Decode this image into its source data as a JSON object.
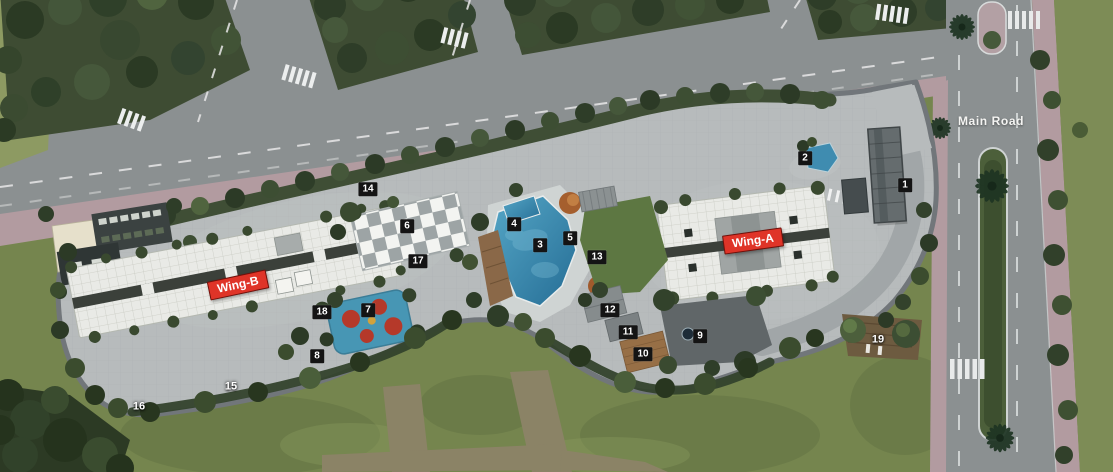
{
  "canvas": {
    "width": 1113,
    "height": 472
  },
  "scene": "aerial master plan render of residential complex",
  "road_label": {
    "text": "Main Road",
    "x": 991,
    "y": 121
  },
  "wing_labels": [
    {
      "id": "wing-b",
      "text": "Wing-B",
      "x": 238,
      "y": 285,
      "rotation": -12,
      "bg": "#df3428",
      "fg": "#ffffff"
    },
    {
      "id": "wing-a",
      "text": "Wing-A",
      "x": 753,
      "y": 241,
      "rotation": -8,
      "bg": "#df3428",
      "fg": "#ffffff"
    }
  ],
  "markers": [
    {
      "num": "1",
      "x": 905,
      "y": 185,
      "boxed": true
    },
    {
      "num": "2",
      "x": 805,
      "y": 158,
      "boxed": true
    },
    {
      "num": "3",
      "x": 540,
      "y": 245,
      "boxed": true
    },
    {
      "num": "4",
      "x": 514,
      "y": 224,
      "boxed": true
    },
    {
      "num": "5",
      "x": 570,
      "y": 238,
      "boxed": true
    },
    {
      "num": "6",
      "x": 407,
      "y": 226,
      "boxed": true
    },
    {
      "num": "7",
      "x": 368,
      "y": 310,
      "boxed": true
    },
    {
      "num": "8",
      "x": 317,
      "y": 356,
      "boxed": true
    },
    {
      "num": "9",
      "x": 700,
      "y": 336,
      "boxed": true
    },
    {
      "num": "10",
      "x": 643,
      "y": 354,
      "boxed": true
    },
    {
      "num": "11",
      "x": 628,
      "y": 332,
      "boxed": true
    },
    {
      "num": "12",
      "x": 610,
      "y": 310,
      "boxed": true
    },
    {
      "num": "13",
      "x": 597,
      "y": 257,
      "boxed": true
    },
    {
      "num": "14",
      "x": 368,
      "y": 189,
      "boxed": true
    },
    {
      "num": "15",
      "x": 231,
      "y": 387,
      "boxed": false
    },
    {
      "num": "16",
      "x": 139,
      "y": 407,
      "boxed": false
    },
    {
      "num": "17",
      "x": 418,
      "y": 261,
      "boxed": true
    },
    {
      "num": "18",
      "x": 322,
      "y": 312,
      "boxed": true
    },
    {
      "num": "19",
      "x": 878,
      "y": 340,
      "boxed": false
    }
  ],
  "marker_style": {
    "bg": "#141414",
    "fg": "#ffffff"
  },
  "colors": {
    "accent_red": "#df3428",
    "marker_bg": "#141414",
    "pool_blue": "#3a8cb2",
    "playground_blue": "#4796b4",
    "road_gray": "#8b9091",
    "site_pavement": "#b7bbbc",
    "sidewalk_pink": "#b29ba0",
    "lawn_green": "#75854e",
    "tree_green": "#3c4c31",
    "roof_white": "#e9eae6"
  }
}
